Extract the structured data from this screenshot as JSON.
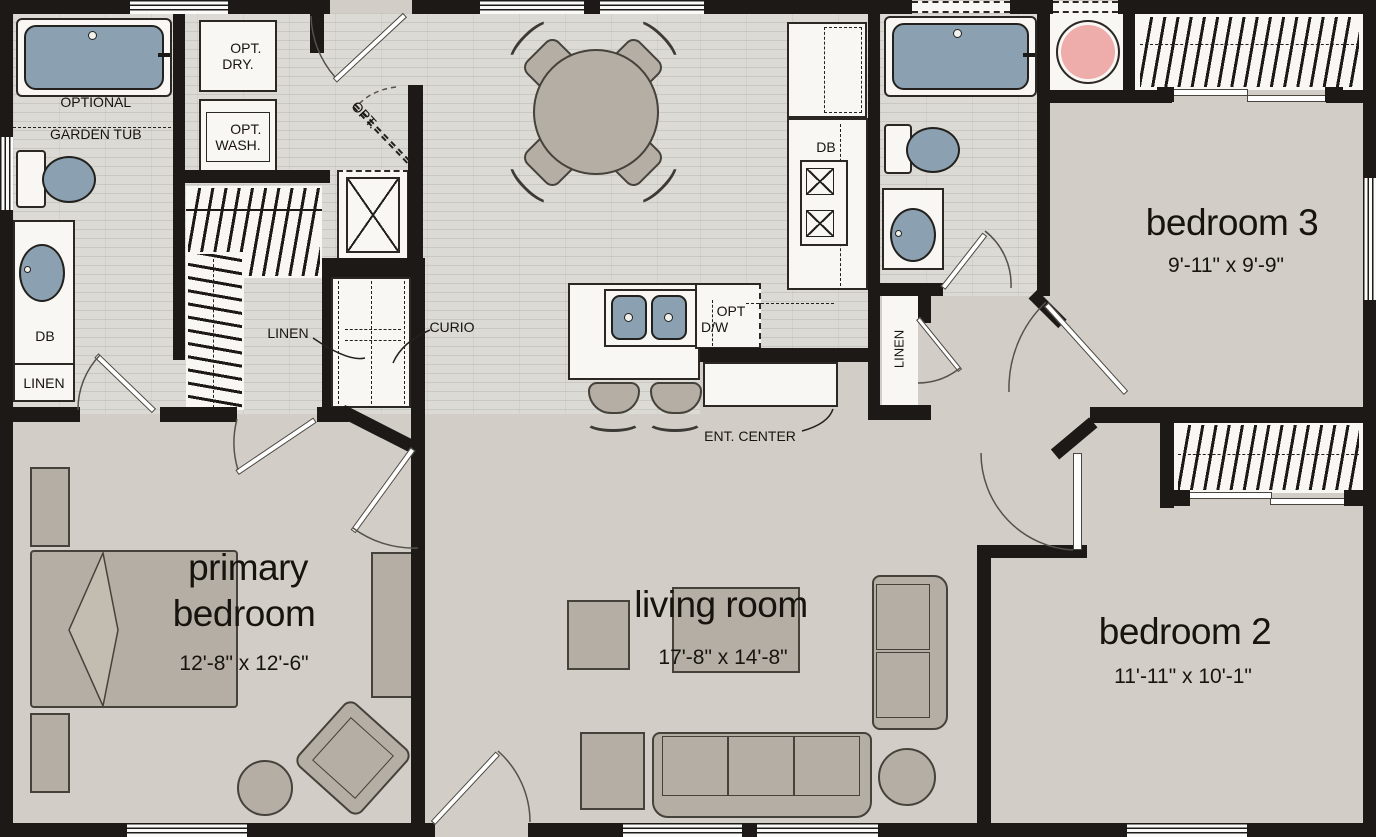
{
  "plan": {
    "rooms": {
      "primary_bedroom": {
        "name_line1": "primary",
        "name_line2": "bedroom",
        "dims": "12'-8\" x 12'-6\""
      },
      "living_room": {
        "name": "living room",
        "dims": "17'-8\" x 14'-8\""
      },
      "bedroom2": {
        "name": "bedroom 2",
        "dims": "11'-11\" x 10'-1\""
      },
      "bedroom3": {
        "name": "bedroom 3",
        "dims": "9'-11\" x 9'-9\""
      }
    },
    "labels": {
      "optional_garden_tub_line1": "OPTIONAL",
      "optional_garden_tub_line2": "GARDEN TUB",
      "opt_dry_line1": "OPT.",
      "opt_dry_line2": "DRY.",
      "opt_wash_line1": "OPT.",
      "opt_wash_line2": "WASH.",
      "opt_door": "OPT.",
      "db_bath": "DB",
      "db_kitchen": "DB",
      "linen_bath": "LINEN",
      "linen_hall_closet": "LINEN",
      "linen_hallway": "LINEN",
      "curio": "CURIO",
      "opt_dw_line1": "OPT",
      "opt_dw_line2": "D/W",
      "ent_center": "ENT. CENTER"
    },
    "colors": {
      "wall": "#1c1916",
      "floor_plank": "#dbdad4",
      "floor_beige": "#d2cec7",
      "fixture_white": "#f8f7f3",
      "fixture_blue": "#8ba1b2",
      "accent_pink": "#eeacab",
      "furniture": "#b5aea4",
      "text": "#17140f"
    }
  }
}
